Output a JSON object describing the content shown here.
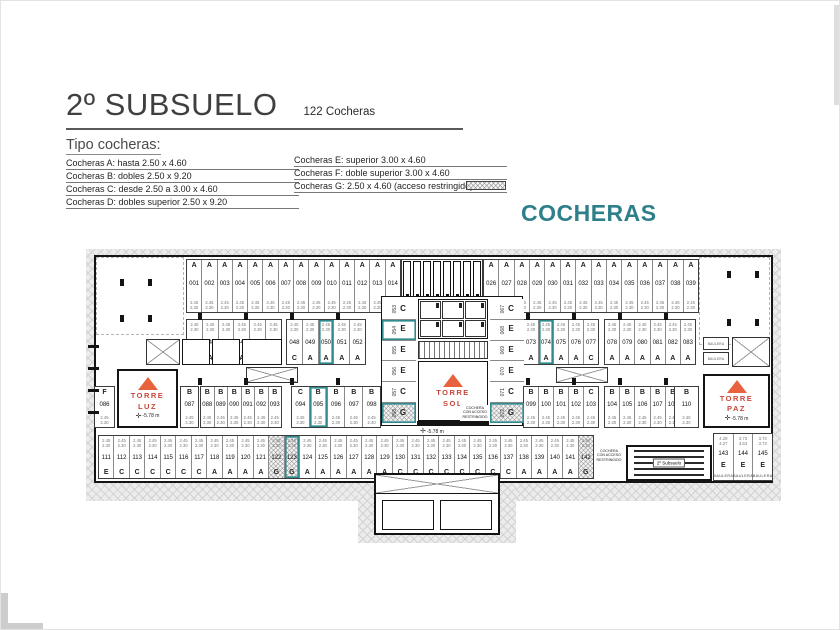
{
  "header": {
    "title": "2º SUBSUELO",
    "subtitle": "122 Cocheras"
  },
  "legend": {
    "heading": "Tipo cocheras:",
    "left_items": [
      "Cocheras A: hasta 2.50 x 4.60",
      "Cocheras B: dobles 2.50 x 9.20",
      "Cocheras C: desde 2.50 a 3.00 x 4.60",
      "Cocheras D: dobles superior 2.50 x 9.20"
    ],
    "right_items": [
      {
        "text": "Cocheras E: superior 3.00 x 4.60",
        "swatch": false
      },
      {
        "text": "Cocheras F: doble superior 3.00 x 4.60",
        "swatch": false
      },
      {
        "text": "Cocheras G: 2.50 x 4.60 (acceso restringido)",
        "swatch": true
      }
    ],
    "watermark": "COCHERAS"
  },
  "plan": {
    "level_label": "-5.78 m",
    "ramp_label": "2º Subsuelo",
    "baulera_label": "BAULERA",
    "restricted_note": [
      "COCHERA",
      "CON ACCESO",
      "RESTRINGIDO"
    ],
    "dims": {
      "a": "2.45",
      "b": "2.30"
    },
    "towers": {
      "left": [
        "TORRE",
        "LUZ"
      ],
      "center": [
        "TORRE",
        "SOL"
      ],
      "right": [
        "TORRE",
        "PAZ"
      ]
    },
    "colors": {
      "highlight": "#2f8c8e",
      "tower_text": "#c9473a",
      "triangle": "#e8623d",
      "watermark": "#2e7f8a"
    },
    "rows": {
      "top_left": [
        {
          "n": "001",
          "t": "A"
        },
        {
          "n": "002",
          "t": "A"
        },
        {
          "n": "003",
          "t": "A"
        },
        {
          "n": "004",
          "t": "A"
        },
        {
          "n": "005",
          "t": "A"
        },
        {
          "n": "006",
          "t": "A"
        },
        {
          "n": "007",
          "t": "A"
        },
        {
          "n": "008",
          "t": "A"
        },
        {
          "n": "009",
          "t": "A"
        },
        {
          "n": "010",
          "t": "A"
        },
        {
          "n": "011",
          "t": "A"
        },
        {
          "n": "012",
          "t": "A"
        },
        {
          "n": "013",
          "t": "A"
        },
        {
          "n": "014",
          "t": "A"
        }
      ],
      "top_right": [
        {
          "n": "026",
          "t": "A"
        },
        {
          "n": "027",
          "t": "A"
        },
        {
          "n": "028",
          "t": "A"
        },
        {
          "n": "029",
          "t": "A"
        },
        {
          "n": "030",
          "t": "A"
        },
        {
          "n": "031",
          "t": "A"
        },
        {
          "n": "032",
          "t": "A"
        },
        {
          "n": "033",
          "t": "A"
        },
        {
          "n": "034",
          "t": "A"
        },
        {
          "n": "035",
          "t": "A"
        },
        {
          "n": "036",
          "t": "A"
        },
        {
          "n": "037",
          "t": "A"
        },
        {
          "n": "038",
          "t": "A"
        },
        {
          "n": "039",
          "t": "A"
        }
      ],
      "mid_left_a": [
        {
          "n": "042",
          "t": "A"
        },
        {
          "n": "043",
          "t": "A"
        },
        {
          "n": "044",
          "t": "A"
        },
        {
          "n": "045",
          "t": "A"
        },
        {
          "n": "046",
          "t": "A"
        },
        {
          "n": "047",
          "t": "A"
        }
      ],
      "mid_left_b": [
        {
          "n": "048",
          "t": "C"
        },
        {
          "n": "049",
          "t": "A"
        },
        {
          "n": "050",
          "t": "A",
          "hl": true
        },
        {
          "n": "051",
          "t": "A"
        },
        {
          "n": "052",
          "t": "A"
        }
      ],
      "core_left": [
        {
          "n": "053",
          "t": "C"
        },
        {
          "n": "054",
          "t": "E",
          "hl": true
        },
        {
          "n": "055",
          "t": "E"
        },
        {
          "n": "056",
          "t": "E"
        },
        {
          "n": "057",
          "t": "C"
        },
        {
          "n": "058",
          "t": "G",
          "hl": true
        }
      ],
      "core_right": [
        {
          "n": "067",
          "t": "C"
        },
        {
          "n": "068",
          "t": "E"
        },
        {
          "n": "069",
          "t": "E"
        },
        {
          "n": "070",
          "t": "E"
        },
        {
          "n": "071",
          "t": "C"
        },
        {
          "n": "072",
          "t": "G",
          "hl": true
        }
      ],
      "mid_right_a": [
        {
          "n": "073",
          "t": "A"
        },
        {
          "n": "074",
          "t": "A",
          "hl": true
        },
        {
          "n": "075",
          "t": "A"
        },
        {
          "n": "076",
          "t": "A"
        },
        {
          "n": "077",
          "t": "C"
        }
      ],
      "mid_right_b": [
        {
          "n": "078",
          "t": "A"
        },
        {
          "n": "079",
          "t": "A"
        },
        {
          "n": "080",
          "t": "A"
        },
        {
          "n": "081",
          "t": "A"
        },
        {
          "n": "082",
          "t": "A"
        },
        {
          "n": "083",
          "t": "A"
        }
      ],
      "stall_f": [
        {
          "n": "086",
          "t": "F"
        }
      ],
      "stall_b087": [
        {
          "n": "087",
          "t": "B"
        }
      ],
      "b_left_a": [
        {
          "n": "088",
          "t": "B"
        },
        {
          "n": "089",
          "t": "B"
        },
        {
          "n": "090",
          "t": "B"
        },
        {
          "n": "091",
          "t": "B"
        },
        {
          "n": "092",
          "t": "B"
        },
        {
          "n": "093",
          "t": "B"
        }
      ],
      "b_left_b": [
        {
          "n": "094",
          "t": "C"
        },
        {
          "n": "095",
          "t": "B",
          "hl": true
        },
        {
          "n": "096",
          "t": "B"
        },
        {
          "n": "097",
          "t": "B"
        },
        {
          "n": "098",
          "t": "B"
        }
      ],
      "b_right_a": [
        {
          "n": "099",
          "t": "B"
        },
        {
          "n": "100",
          "t": "B"
        },
        {
          "n": "101",
          "t": "B"
        },
        {
          "n": "102",
          "t": "B"
        },
        {
          "n": "103",
          "t": "C"
        }
      ],
      "b_right_b": [
        {
          "n": "104",
          "t": "B"
        },
        {
          "n": "105",
          "t": "B"
        },
        {
          "n": "106",
          "t": "B"
        },
        {
          "n": "107",
          "t": "B"
        },
        {
          "n": "108",
          "t": "B"
        },
        {
          "n": "109",
          "t": "B"
        }
      ],
      "stall_b110": [
        {
          "n": "110",
          "t": "B"
        }
      ],
      "bottom": [
        {
          "n": "111",
          "t": "E"
        },
        {
          "n": "112",
          "t": "C"
        },
        {
          "n": "113",
          "t": "C"
        },
        {
          "n": "114",
          "t": "C"
        },
        {
          "n": "115",
          "t": "C"
        },
        {
          "n": "116",
          "t": "C"
        },
        {
          "n": "117",
          "t": "C"
        },
        {
          "n": "118",
          "t": "A"
        },
        {
          "n": "119",
          "t": "A"
        },
        {
          "n": "120",
          "t": "A"
        },
        {
          "n": "121",
          "t": "A"
        },
        {
          "n": "122",
          "t": "G"
        },
        {
          "n": "123",
          "t": "G",
          "hl": true
        },
        {
          "n": "124",
          "t": "A"
        },
        {
          "n": "125",
          "t": "A"
        },
        {
          "n": "126",
          "t": "A"
        },
        {
          "n": "127",
          "t": "A"
        },
        {
          "n": "128",
          "t": "A"
        },
        {
          "n": "129",
          "t": "A"
        },
        {
          "n": "130",
          "t": "C"
        },
        {
          "n": "131",
          "t": "C"
        },
        {
          "n": "132",
          "t": "C"
        },
        {
          "n": "133",
          "t": "C"
        },
        {
          "n": "134",
          "t": "C"
        },
        {
          "n": "135",
          "t": "C"
        },
        {
          "n": "136",
          "t": "C"
        },
        {
          "n": "137",
          "t": "C"
        },
        {
          "n": "138",
          "t": "A"
        },
        {
          "n": "139",
          "t": "A"
        },
        {
          "n": "140",
          "t": "A"
        },
        {
          "n": "141",
          "t": "A"
        },
        {
          "n": "142",
          "t": "G"
        }
      ],
      "bottom_right": [
        {
          "n": "143",
          "t": "E",
          "dim": "4.29",
          "dim2": "4.27",
          "sub": "BAULERA"
        },
        {
          "n": "144",
          "t": "E",
          "dim": "3.73",
          "dim2": "3.53",
          "sub": "BAULERA"
        },
        {
          "n": "145",
          "t": "E",
          "dim": "3.73",
          "dim2": "3.73",
          "sub": "BAULERA"
        }
      ]
    }
  }
}
